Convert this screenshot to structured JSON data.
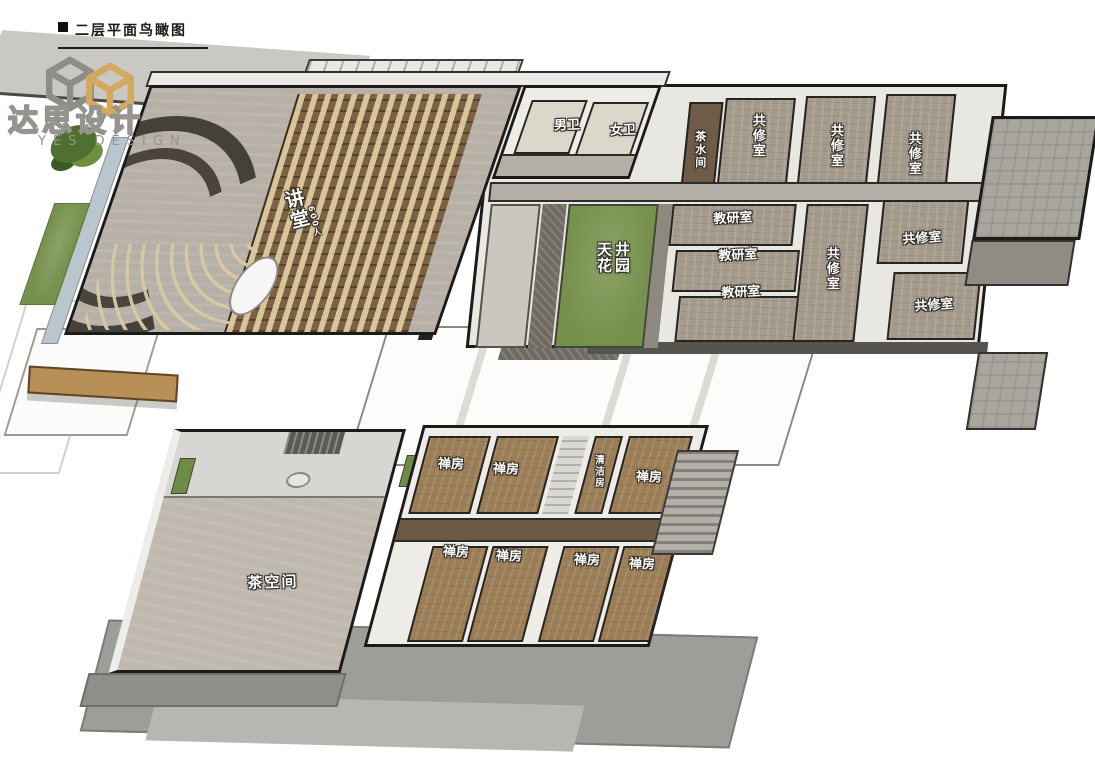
{
  "header": {
    "title": "二层平面鸟瞰图"
  },
  "logo": {
    "brand_cn": "达思设计",
    "brand_en": "YES DESIGN"
  },
  "colors": {
    "accent_gold": "#d2a95e",
    "logo_gray": "#96948f",
    "ink": "#1b1b19",
    "lawn_green": "#76914c",
    "zen_wood_brown": "#9c7f58",
    "hall_floor_gray": "#bfb8ae",
    "seat_cushion_beige": "#d9c9a4",
    "water_blue": "#b9c6cd"
  },
  "upper_floor": {
    "lecture_hall": {
      "label": "讲堂",
      "capacity": "600人"
    },
    "restrooms": {
      "male": "男卫",
      "female": "女卫"
    },
    "tea_water_room": "茶水间",
    "practice_rooms_top": [
      "共修室",
      "共修室",
      "共修室"
    ],
    "courtyard_garden": "天井花园",
    "research_rooms": [
      "教研室",
      "教研室",
      "教研室"
    ],
    "practice_room_center": "共修室",
    "practice_rooms_right": [
      "共修室",
      "共修室"
    ]
  },
  "lower_floor": {
    "tea_space": "茶空间",
    "zen_rooms_top": [
      "禅房",
      "禅房",
      "禅房"
    ],
    "cleaning_room": "清洁房",
    "zen_rooms_bottom": [
      "禅房",
      "禅房",
      "禅房",
      "禅房"
    ]
  }
}
